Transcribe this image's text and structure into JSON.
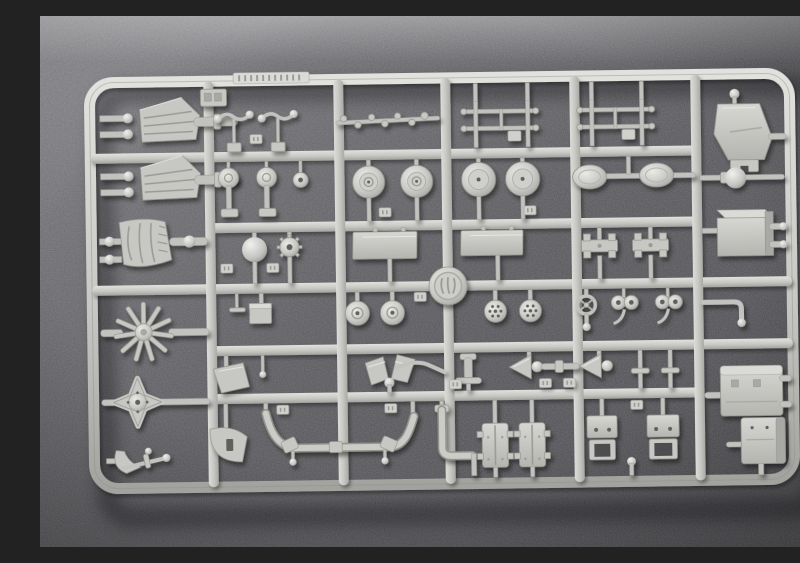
{
  "scene": {
    "description": "Photograph of a light grey injection-moulded plastic model kit sprue (parts tree) laid on dark grey speckled felt, lit from the upper left",
    "object": "model-kit-sprue",
    "background": "dark mottled felt cloth",
    "lighting": "soft daylight from top-left, parts cast small shadows down-right"
  },
  "colors": {
    "plastic_base": "#c7c8c3",
    "plastic_highlight": "#e8e9e4",
    "plastic_shadow": "#a4a5a0",
    "felt_mid": "#59595c",
    "felt_light": "#98989b",
    "felt_dark": "#454548"
  },
  "sprue": {
    "frame": "rounded rectangle outer frame",
    "horizontal_runners": 5,
    "vertical_runners": 5,
    "maker_medallion": "embossed circular logo medallion at a central runner junction",
    "mold_code_tab": "raised embossed code strip on the top rail (illegible)",
    "part_number_tabs": "small raised numbered tags beside parts (illegible)"
  },
  "parts": [
    {
      "name": "ribbed-wedge-panel",
      "count": 2
    },
    {
      "name": "pod-cylinder",
      "count": 2
    },
    {
      "name": "ball-top-lever",
      "count": 2
    },
    {
      "name": "nubbed-linkage-rod",
      "count": 1
    },
    {
      "name": "handrail-h-frame",
      "count": 2
    },
    {
      "name": "hopper-trapezoid-panel",
      "count": 1
    },
    {
      "name": "disc-head-post",
      "count": 2
    },
    {
      "name": "washer-disc",
      "count": 1
    },
    {
      "name": "road-wheel-large",
      "count": 4
    },
    {
      "name": "oval-pad",
      "count": 2
    },
    {
      "name": "ball-knob",
      "count": 1
    },
    {
      "name": "ribbed-cowl-panel",
      "count": 1
    },
    {
      "name": "sphere",
      "count": 1
    },
    {
      "name": "sprocket-gear",
      "count": 1
    },
    {
      "name": "rectangular-plate",
      "count": 2
    },
    {
      "name": "spring-bracket",
      "count": 2
    },
    {
      "name": "three-quarter-box",
      "count": 1
    },
    {
      "name": "cube-on-stem",
      "count": 1
    },
    {
      "name": "tee-stem",
      "count": 1
    },
    {
      "name": "road-wheel-small",
      "count": 2
    },
    {
      "name": "perforated-disc",
      "count": 2
    },
    {
      "name": "hand-wheel",
      "count": 1
    },
    {
      "name": "twin-lens-link",
      "count": 2
    },
    {
      "name": "elbow-rod",
      "count": 1
    },
    {
      "name": "radial-fan-wheel",
      "count": 1
    },
    {
      "name": "four-point-cross-hub",
      "count": 1
    },
    {
      "name": "pick-lever",
      "count": 1
    },
    {
      "name": "blade-flag",
      "count": 1
    },
    {
      "name": "v-twin-blade",
      "count": 1
    },
    {
      "name": "tee-pipe",
      "count": 1
    },
    {
      "name": "funnel-horn",
      "count": 2
    },
    {
      "name": "coupling-rod",
      "count": 1
    },
    {
      "name": "tee-pin-pole",
      "count": 2
    },
    {
      "name": "quadrant-pedal",
      "count": 1
    },
    {
      "name": "exhaust-pipe-run",
      "count": 1
    },
    {
      "name": "elbow-drain-pipe",
      "count": 1
    },
    {
      "name": "ladder-frame-plate",
      "count": 2
    },
    {
      "name": "seat-bracket",
      "count": 2
    },
    {
      "name": "bottom-pin",
      "count": 1
    },
    {
      "name": "large-block",
      "count": 2
    },
    {
      "name": "corner-detail-plate",
      "count": 1
    }
  ]
}
